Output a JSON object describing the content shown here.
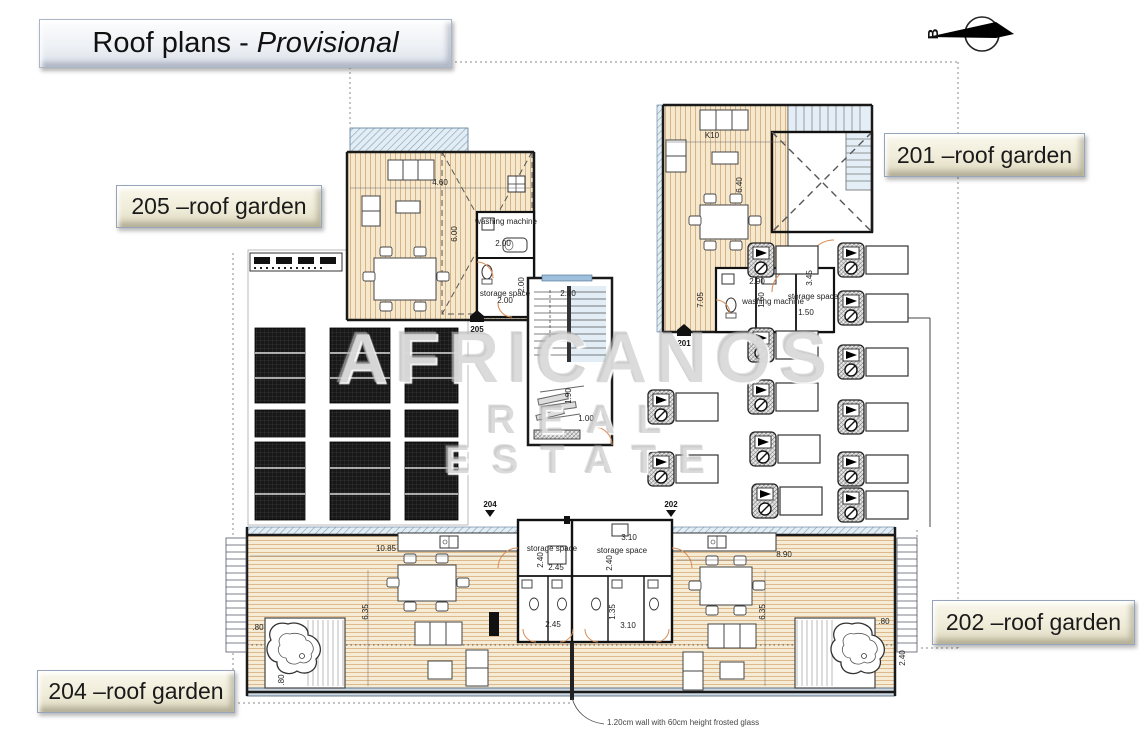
{
  "title": {
    "prefix": "Roof plans -",
    "emphasis": "Provisional"
  },
  "north_indicator": {
    "letter": "B"
  },
  "watermark": {
    "line1": "AFRICANOS",
    "line2": "REAL ESTATE"
  },
  "unit_labels": [
    {
      "id": "205",
      "text": "205 –roof garden"
    },
    {
      "id": "201",
      "text": "201 –roof garden"
    },
    {
      "id": "202",
      "text": "202 –roof garden"
    },
    {
      "id": "204",
      "text": "204 –roof garden"
    }
  ],
  "note": {
    "text": "1.20cm wall with 60cm height frosted glass"
  },
  "plan_markers": [
    {
      "id": "205",
      "x": 477,
      "y": 310,
      "shape": "house"
    },
    {
      "id": "201",
      "x": 684,
      "y": 324,
      "shape": "house"
    },
    {
      "id": "204",
      "x": 490,
      "y": 507,
      "shape": "arrow"
    },
    {
      "id": "202",
      "x": 671,
      "y": 507,
      "shape": "arrow"
    }
  ],
  "dimensions": [
    {
      "text": "4.60",
      "x": 440,
      "y": 185
    },
    {
      "text": "6.00",
      "x": 457,
      "y": 234,
      "rot": -90
    },
    {
      "text": "2.00",
      "x": 503,
      "y": 246
    },
    {
      "text": "2.00",
      "x": 524,
      "y": 285,
      "rot": -90
    },
    {
      "text": "2.00",
      "x": 505,
      "y": 303
    },
    {
      "text": "2.40",
      "x": 568,
      "y": 296
    },
    {
      "text": "1.90",
      "x": 571,
      "y": 396,
      "rot": -90
    },
    {
      "text": "1.00",
      "x": 586,
      "y": 421
    },
    {
      "text": "K10",
      "x": 712,
      "y": 138
    },
    {
      "text": "6.40",
      "x": 742,
      "y": 185,
      "rot": -90
    },
    {
      "text": "7.05",
      "x": 703,
      "y": 300,
      "rot": -90
    },
    {
      "text": "2.90",
      "x": 757,
      "y": 284
    },
    {
      "text": "1.60",
      "x": 764,
      "y": 300,
      "rot": -90
    },
    {
      "text": "1.50",
      "x": 806,
      "y": 315
    },
    {
      "text": "3.45",
      "x": 812,
      "y": 278,
      "rot": -90
    },
    {
      "text": "10.85",
      "x": 386,
      "y": 551
    },
    {
      "text": "8.90",
      "x": 784,
      "y": 557
    },
    {
      "text": "3.10",
      "x": 629,
      "y": 540
    },
    {
      "text": "2.40",
      "x": 543,
      "y": 560,
      "rot": -90
    },
    {
      "text": "2.45",
      "x": 556,
      "y": 570
    },
    {
      "text": "2.40",
      "x": 612,
      "y": 563,
      "rot": -90
    },
    {
      "text": "1.35",
      "x": 615,
      "y": 612,
      "rot": -90
    },
    {
      "text": "2.45",
      "x": 553,
      "y": 627
    },
    {
      "text": "3.10",
      "x": 628,
      "y": 628
    },
    {
      "text": "6.35",
      "x": 368,
      "y": 612,
      "rot": -90
    },
    {
      "text": "6.35",
      "x": 765,
      "y": 612,
      "rot": -90
    },
    {
      "text": ".80",
      "x": 258,
      "y": 630
    },
    {
      "text": ".80",
      "x": 884,
      "y": 624
    },
    {
      "text": ".80",
      "x": 284,
      "y": 680,
      "rot": -90
    },
    {
      "text": "2.40",
      "x": 905,
      "y": 658,
      "rot": -90
    },
    {
      "text": "washing machine",
      "x": 506,
      "y": 224,
      "size": 4
    },
    {
      "text": "storage space",
      "x": 505,
      "y": 296,
      "size": 4
    },
    {
      "text": "washing machine",
      "x": 773,
      "y": 304,
      "size": 4
    },
    {
      "text": "storage space",
      "x": 813,
      "y": 299,
      "size": 4
    },
    {
      "text": "storage space",
      "x": 552,
      "y": 551,
      "size": 4
    },
    {
      "text": "storage space",
      "x": 622,
      "y": 553,
      "size": 4
    }
  ],
  "colors": {
    "wood": "#f6e8cd",
    "wood_line": "#d7b488",
    "wall": "#1a1a1a",
    "hatch_blue": "#7f9fba",
    "stair_tint": "#e2edf5",
    "door": "#d98c55",
    "panel_dark": "#181818",
    "watermark": "#bebebe",
    "label_tan": "#efecd9"
  }
}
